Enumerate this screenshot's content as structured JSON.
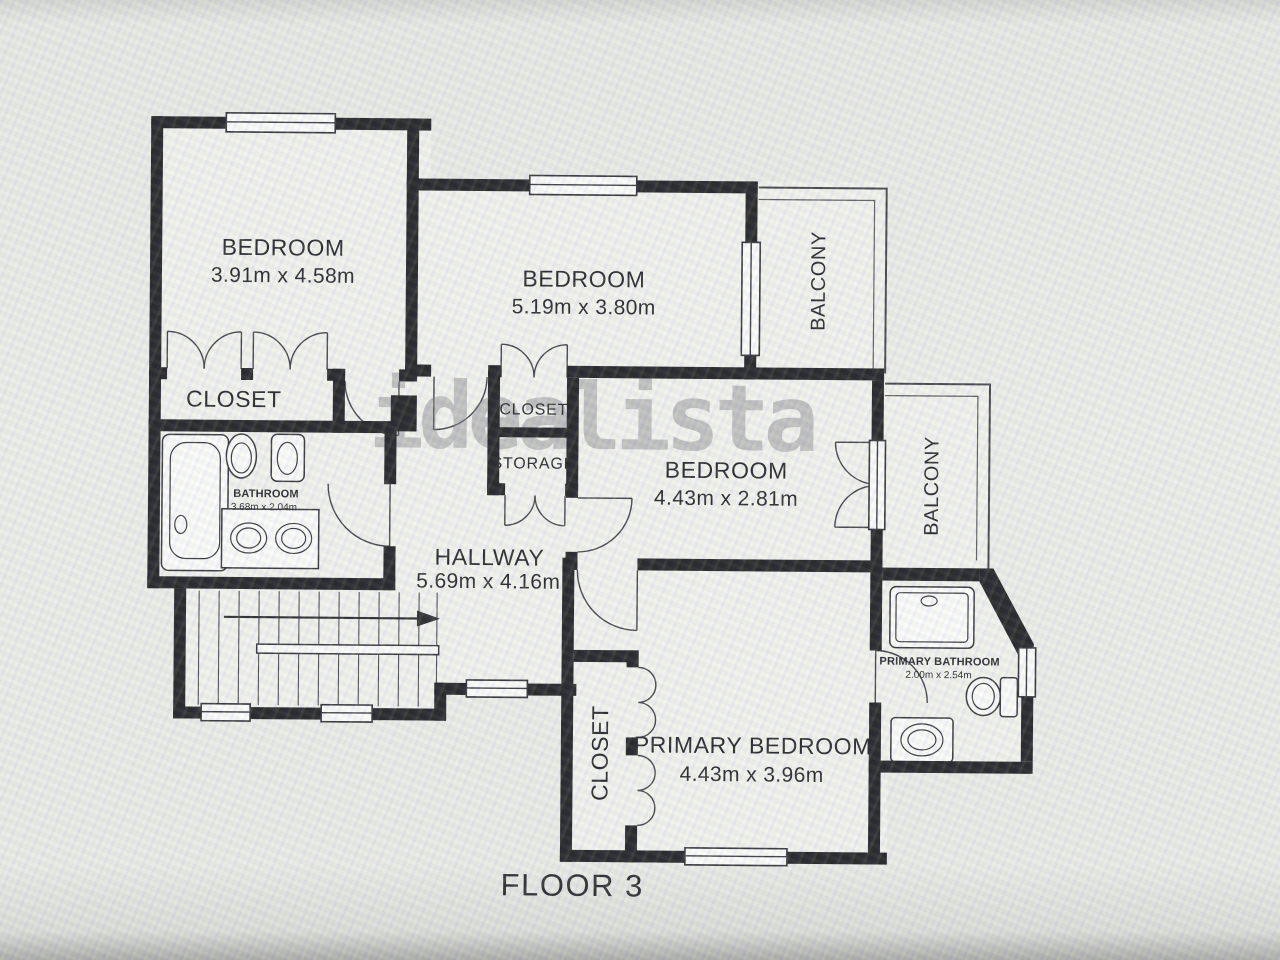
{
  "floor_label": "FLOOR 3",
  "watermark": "idealista",
  "colors": {
    "wall": "#1b1b1e",
    "floor": "#f1f1ec",
    "paper": "#ecede8",
    "watermark": "#77777b"
  },
  "rooms": {
    "bedroom_top_left": {
      "name": "BEDROOM",
      "dims": "3.91m x 4.58m"
    },
    "bedroom_top_mid": {
      "name": "BEDROOM",
      "dims": "5.19m x 3.80m"
    },
    "bedroom_mid_right": {
      "name": "BEDROOM",
      "dims": "4.43m x 2.81m"
    },
    "primary_bedroom": {
      "name": "PRIMARY BEDROOM",
      "dims": "4.43m x 3.96m"
    },
    "hallway": {
      "name": "HALLWAY",
      "dims": "5.69m x 4.16m"
    },
    "bathroom": {
      "name": "BATHROOM",
      "dims": "3.68m x 2.04m"
    },
    "primary_bathroom": {
      "name": "PRIMARY BATHROOM",
      "dims": "2.00m x 2.54m"
    },
    "closet_left": {
      "name": "CLOSET"
    },
    "closet_mid": {
      "name": "CLOSET"
    },
    "storage": {
      "name": "STORAGE"
    },
    "closet_primary": {
      "name": "CLOSET"
    },
    "balcony_top": {
      "name": "BALCONY"
    },
    "balcony_right": {
      "name": "BALCONY"
    }
  }
}
